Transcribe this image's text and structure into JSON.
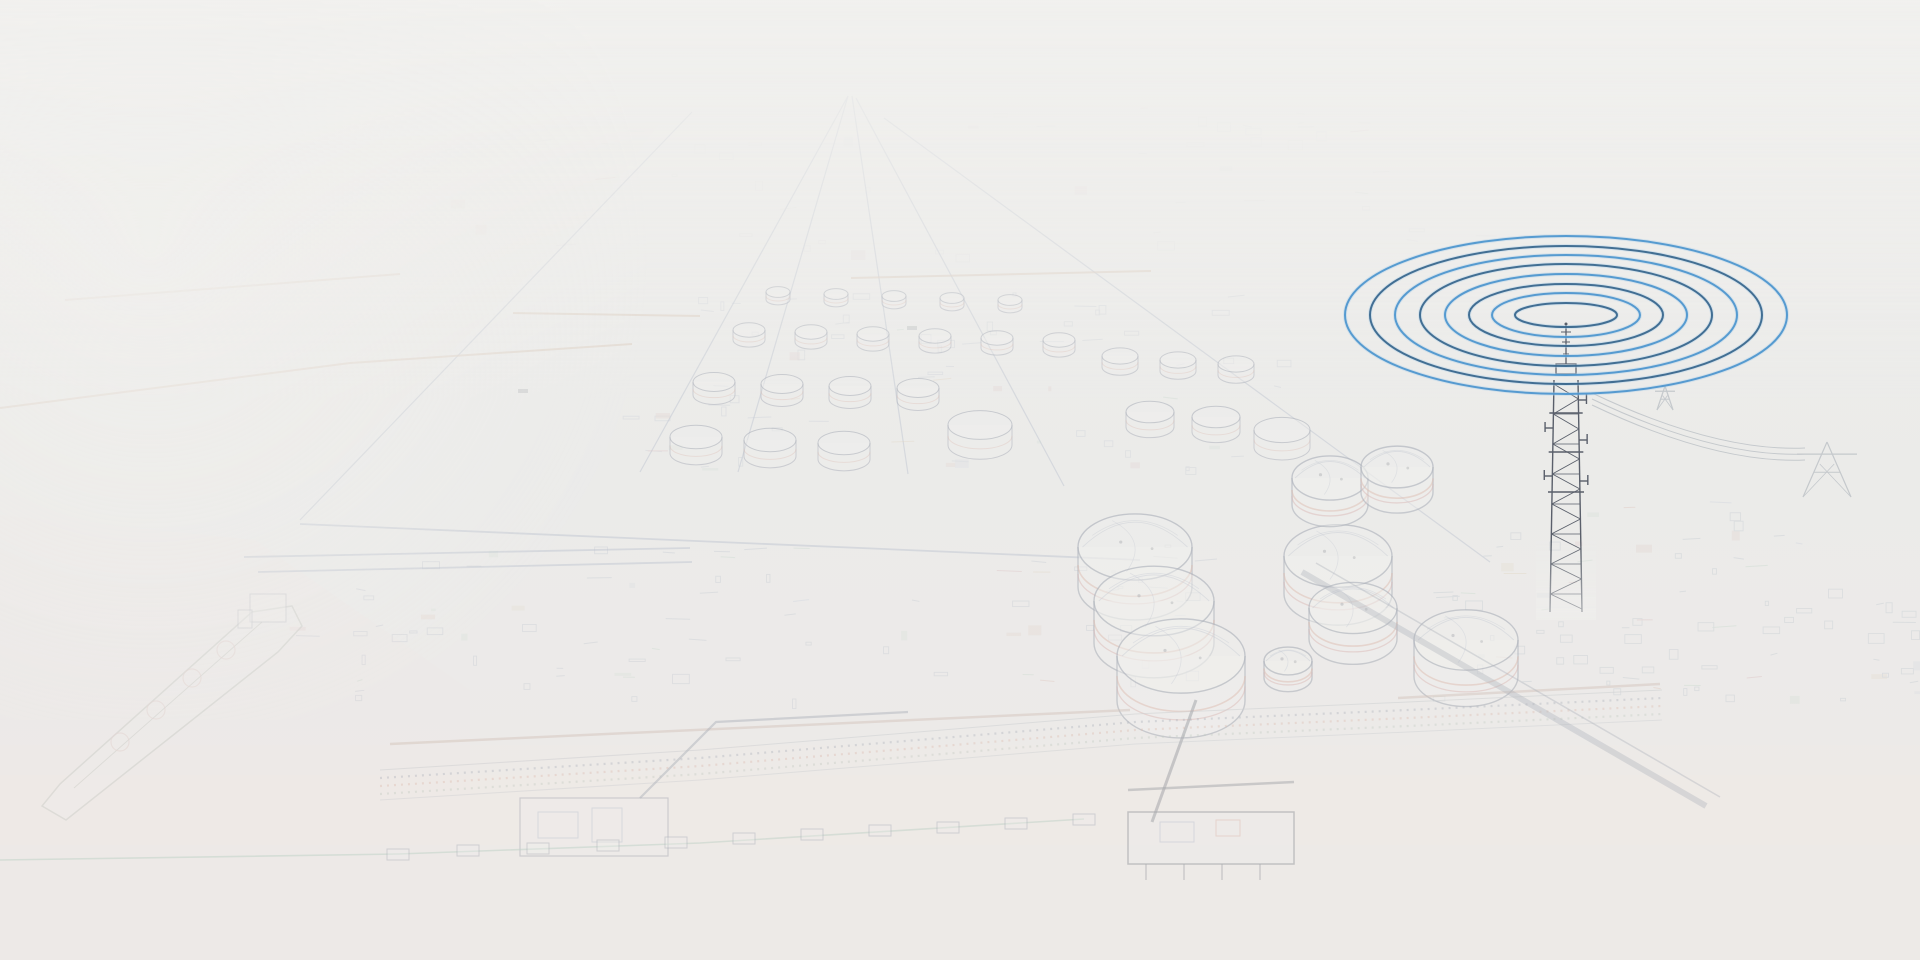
{
  "meta": {
    "width": 1920,
    "height": 960,
    "description": "Faded pencil-sketch aerial view of a coastal LNG terminal with storage tanks, piers, an LNG carrier ship, and a telecom tower emitting blue concentric radio-wave rings"
  },
  "palette": {
    "bg_top": "#ecebe9",
    "bg_mid": "#e8e8e7",
    "bg_bottom": "#ebe6e4",
    "water_left": "#e9e7e4",
    "water_bottom": "#ebe5e3",
    "ink_blue": "#7585a5",
    "ink_navy": "#47536e",
    "ink_dark": "#39404e",
    "ink_tan": "#c4a183",
    "ink_rust": "#c06b4f",
    "ink_green": "#76a98f",
    "veil": "#f1f0ee",
    "ring_light": "#4f97cf",
    "ring_dark": "#3a688e",
    "ring_halo": "#aecfe8",
    "tower_ink": "#39404e",
    "accents": [
      "#bf6f58",
      "#7fae8f",
      "#8a9ac0",
      "#c9a06a",
      "#b85f6a"
    ]
  },
  "scene": {
    "radio_waves": {
      "cx": 1566,
      "cy": 315,
      "stroke_width": 2,
      "halo_width": 4,
      "rings": [
        {
          "rx": 51,
          "ry": 12,
          "tone": "dark"
        },
        {
          "rx": 74,
          "ry": 22,
          "tone": "light"
        },
        {
          "rx": 97,
          "ry": 31,
          "tone": "dark"
        },
        {
          "rx": 121,
          "ry": 41,
          "tone": "light"
        },
        {
          "rx": 146,
          "ry": 51,
          "tone": "dark"
        },
        {
          "rx": 171,
          "ry": 60,
          "tone": "light"
        },
        {
          "rx": 196,
          "ry": 69,
          "tone": "dark"
        },
        {
          "rx": 221,
          "ry": 79,
          "tone": "light"
        }
      ]
    },
    "tower": {
      "cx": 1566,
      "cap_y": 372,
      "base_y": 612,
      "mast_top_y": 325,
      "rail_top_half": 12,
      "rail_base_half": 16,
      "stubs": [
        {
          "y": 400,
          "side": 1
        },
        {
          "y": 428,
          "side": -1
        },
        {
          "y": 440,
          "side": 1
        },
        {
          "y": 476,
          "side": -1
        },
        {
          "y": 481,
          "side": 1
        }
      ],
      "platforms": [
        413,
        452,
        492
      ]
    },
    "pylons": [
      {
        "cx": 1665,
        "base_y": 410,
        "h": 24,
        "half_w": 8
      },
      {
        "cx": 1827,
        "base_y": 497,
        "h": 55,
        "half_w": 24
      }
    ],
    "power_lines": {
      "start": [
        1592,
        393
      ],
      "ctrl": [
        1716,
        452
      ],
      "end": [
        1805,
        448
      ],
      "offsets": [
        0,
        6,
        12
      ]
    },
    "roads": {
      "lines": [
        [
          [
            692,
            112
          ],
          [
            300,
            520
          ]
        ],
        [
          [
            848,
            96
          ],
          [
            640,
            472
          ]
        ],
        [
          [
            848,
            96
          ],
          [
            738,
            472
          ]
        ],
        [
          [
            852,
            96
          ],
          [
            908,
            474
          ]
        ],
        [
          [
            856,
            98
          ],
          [
            1064,
            486
          ]
        ],
        [
          [
            884,
            118
          ],
          [
            1490,
            562
          ]
        ]
      ],
      "cross": [
        [
          [
            258,
            572
          ],
          [
            692,
            562
          ]
        ],
        [
          [
            244,
            557
          ],
          [
            690,
            548
          ]
        ],
        [
          [
            300,
            524
          ],
          [
            1140,
            560
          ]
        ]
      ]
    },
    "breakwaters": [
      [
        [
          65,
          300
        ],
        [
          400,
          274
        ]
      ],
      [
        [
          0,
          408
        ],
        [
          350,
          363
        ],
        [
          632,
          344
        ]
      ],
      [
        [
          513,
          313
        ],
        [
          700,
          316
        ]
      ],
      [
        [
          851,
          278
        ],
        [
          1151,
          271
        ]
      ]
    ],
    "boats": [
      [
        523,
        391
      ],
      [
        912,
        328
      ]
    ],
    "shore_band": {
      "top": [
        [
          380,
          770
        ],
        [
          700,
          750
        ],
        [
          1135,
          714
        ],
        [
          1408,
          702
        ],
        [
          1662,
          690
        ]
      ],
      "thickness": 30
    },
    "shore_road": [
      [
        [
          390,
          744
        ],
        [
          1130,
          710
        ]
      ],
      [
        [
          1398,
          698
        ],
        [
          1660,
          684
        ]
      ]
    ],
    "large_tanks": [
      [
        1135,
        547,
        57
      ],
      [
        1154,
        601,
        60
      ],
      [
        1181,
        656,
        64
      ],
      [
        1338,
        556,
        54
      ],
      [
        1353,
        608,
        44
      ],
      [
        1466,
        640,
        52
      ],
      [
        1288,
        661,
        24
      ],
      [
        1330,
        478,
        38
      ],
      [
        1397,
        467,
        36
      ]
    ],
    "small_tanks": [
      [
        778,
        292,
        12
      ],
      [
        836,
        294,
        12
      ],
      [
        894,
        296,
        12
      ],
      [
        952,
        298,
        12
      ],
      [
        1010,
        300,
        12
      ],
      [
        749,
        330,
        16
      ],
      [
        811,
        332,
        16
      ],
      [
        873,
        334,
        16
      ],
      [
        935,
        336,
        16
      ],
      [
        997,
        338,
        16
      ],
      [
        1059,
        340,
        16
      ],
      [
        714,
        382,
        21
      ],
      [
        782,
        384,
        21
      ],
      [
        850,
        386,
        21
      ],
      [
        918,
        388,
        21
      ],
      [
        696,
        437,
        26
      ],
      [
        770,
        440,
        26
      ],
      [
        844,
        443,
        26
      ],
      [
        1120,
        356,
        18
      ],
      [
        1178,
        360,
        18
      ],
      [
        1236,
        364,
        18
      ],
      [
        1150,
        412,
        24
      ],
      [
        1216,
        417,
        24
      ],
      [
        980,
        425,
        32
      ],
      [
        1282,
        430,
        28
      ]
    ],
    "ship": {
      "hull": [
        [
          42,
          806
        ],
        [
          66,
          820
        ],
        [
          278,
          652
        ],
        [
          302,
          626
        ],
        [
          292,
          606
        ],
        [
          252,
          612
        ],
        [
          60,
          784
        ]
      ],
      "deck": [
        [
          74,
          788
        ],
        [
          262,
          622
        ]
      ],
      "superstructure": [
        [
          250,
          594,
          36,
          28
        ],
        [
          238,
          610,
          14,
          18
        ]
      ],
      "domes": [
        [
          120,
          742
        ],
        [
          156,
          710
        ],
        [
          192,
          678
        ],
        [
          226,
          650
        ]
      ],
      "dome_r": 9
    },
    "piers": {
      "p1_platform": [
        520,
        798,
        148,
        58
      ],
      "p1_trestle": [
        [
          640,
          798
        ],
        [
          716,
          722
        ],
        [
          908,
          712
        ]
      ],
      "p2_platform": [
        1128,
        812,
        166,
        52
      ],
      "p2_ramp": [
        [
          1196,
          700
        ],
        [
          1152,
          822
        ]
      ],
      "p2_deck": [
        [
          1128,
          790
        ],
        [
          1294,
          782
        ]
      ],
      "causeway": [
        [
          1302,
          572
        ],
        [
          1706,
          806
        ]
      ]
    },
    "boom": {
      "line": [
        [
          0,
          860
        ],
        [
          398,
          854
        ],
        [
          700,
          843
        ],
        [
          1084,
          819
        ]
      ],
      "floats": [
        [
          398,
          854
        ],
        [
          468,
          850
        ],
        [
          538,
          848
        ],
        [
          608,
          845
        ],
        [
          676,
          842
        ],
        [
          744,
          838
        ],
        [
          812,
          834
        ],
        [
          880,
          830
        ],
        [
          948,
          827
        ],
        [
          1016,
          823
        ],
        [
          1084,
          819
        ]
      ]
    },
    "texture_patches": [
      {
        "name": "distant-city",
        "x": 420,
        "y": 108,
        "w": 1060,
        "h": 150,
        "count": 55,
        "seed": 7,
        "style": "mixed",
        "color": "#a9b0bb",
        "opacity": 0.18
      },
      {
        "name": "tank-farm-clutter",
        "x": 620,
        "y": 290,
        "w": 660,
        "h": 180,
        "count": 70,
        "seed": 11,
        "style": "mixed",
        "color": "#7d8aa8",
        "opacity": 0.3
      },
      {
        "name": "foreground-plant",
        "x": 250,
        "y": 545,
        "w": 950,
        "h": 155,
        "count": 80,
        "seed": 23,
        "style": "mixed",
        "color": "#6e7c9b",
        "opacity": 0.32
      },
      {
        "name": "right-industrial",
        "x": 1430,
        "y": 500,
        "w": 488,
        "h": 200,
        "count": 85,
        "seed": 41,
        "style": "mixed",
        "color": "#70809c",
        "opacity": 0.34
      }
    ]
  }
}
